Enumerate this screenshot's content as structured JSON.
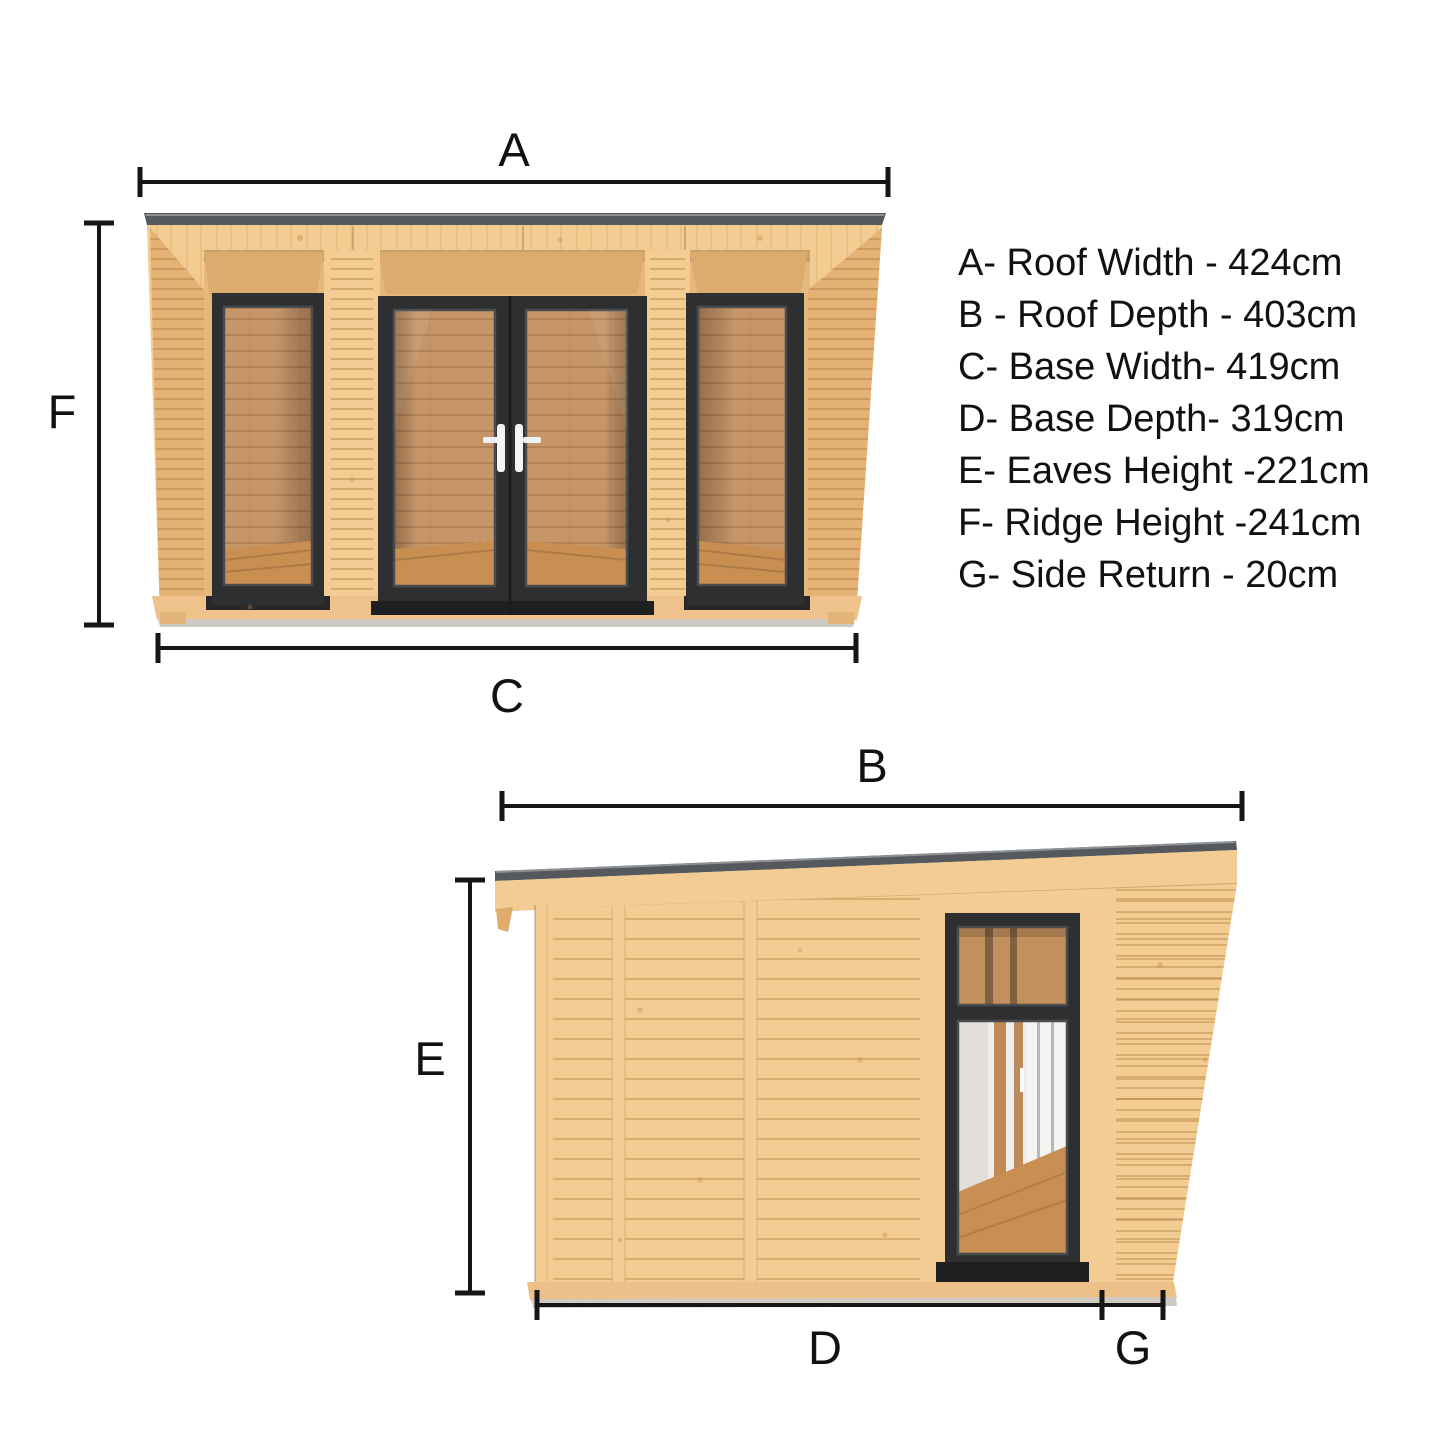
{
  "page": {
    "background": "#ffffff"
  },
  "legend": {
    "items": [
      "A- Roof Width - 424cm",
      "B - Roof Depth - 403cm",
      "C- Base Width- 419cm",
      "D- Base Depth- 319cm",
      "E- Eaves Height -221cm",
      "F- Ridge Height -241cm",
      "G- Side Return - 20cm"
    ]
  },
  "dimension_labels": {
    "a": "A",
    "b": "B",
    "c": "C",
    "d": "D",
    "e": "E",
    "f": "F",
    "g": "G"
  },
  "measurements": [
    {
      "key": "A",
      "label": "Roof Width",
      "value_cm": 424
    },
    {
      "key": "B",
      "label": "Roof Depth",
      "value_cm": 403
    },
    {
      "key": "C",
      "label": "Base Width",
      "value_cm": 419
    },
    {
      "key": "D",
      "label": "Base Depth",
      "value_cm": 319
    },
    {
      "key": "E",
      "label": "Eaves Height",
      "value_cm": 221
    },
    {
      "key": "F",
      "label": "Ridge Height",
      "value_cm": 241
    },
    {
      "key": "G",
      "label": "Side Return",
      "value_cm": 20
    }
  ],
  "views": {
    "front": "front-elevation",
    "side": "side-elevation"
  },
  "colors": {
    "wood_light": "#f2cc92",
    "wood_mid": "#e7b87c",
    "wood_dark": "#dcab6e",
    "wood_reveal": "#e5b275",
    "frame_dark": "#2d2f31",
    "frame_inner": "#4a4d50",
    "roof_gray": "#55585c",
    "interior_wood": "#c69669",
    "floor_wood": "#c98f52",
    "sill_gray": "#cfcac2",
    "dim_line": "#161616",
    "text_color": "#111111",
    "page_bg": "#ffffff"
  }
}
